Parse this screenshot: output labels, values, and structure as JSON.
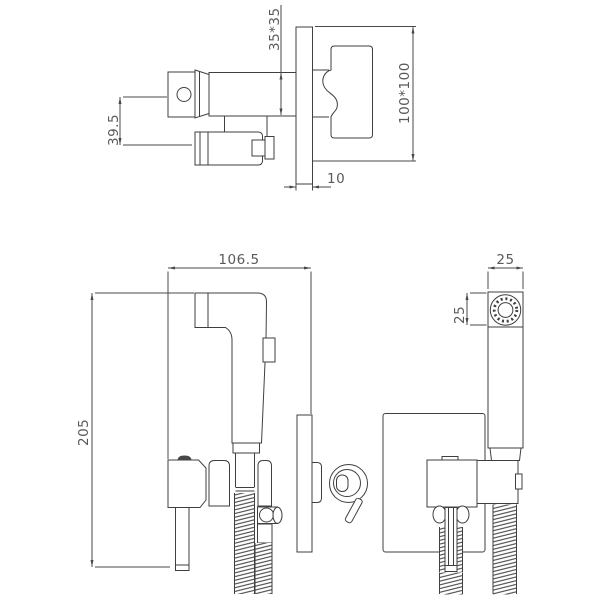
{
  "drawing": {
    "type": "technical-dimension-drawing",
    "subject": "concealed bidet shower mixer set",
    "colors": {
      "line": "#3f3f3f",
      "text": "#595959",
      "background": "#ffffff"
    }
  },
  "dimensions": {
    "handle_body_section": "35*35",
    "handle_offset": "39.5",
    "plate_face": "100*100",
    "plate_thickness": "10",
    "set_depth": "106.5",
    "set_height": "205",
    "sprayer_width": "25",
    "sprayer_head_height": "25"
  }
}
